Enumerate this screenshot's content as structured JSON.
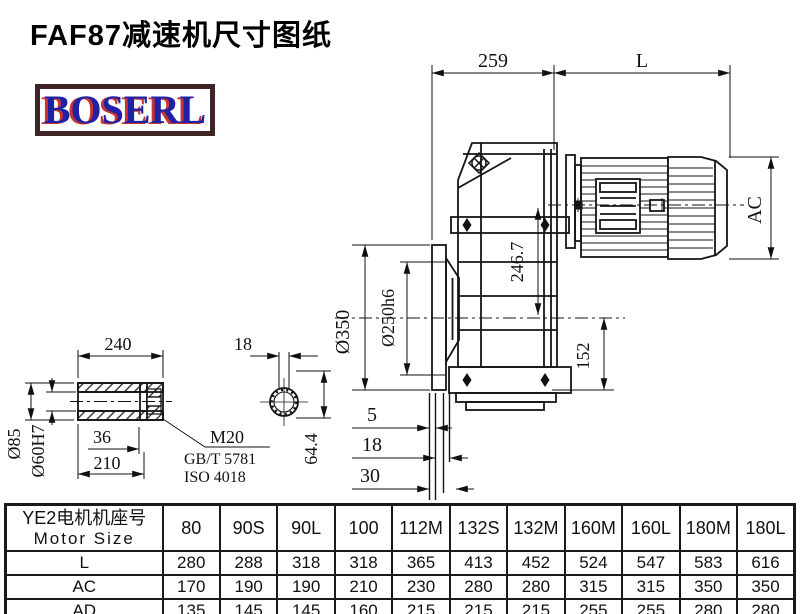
{
  "page": {
    "title": "FAF87减速机尺寸图纸",
    "logo": "BOSERL"
  },
  "colors": {
    "line": "#151515",
    "dim_line": "#111111",
    "logo_border": "#3e2424",
    "logo_text": "#2121a6",
    "logo_shadow": "#c63434"
  },
  "drawing": {
    "dims": {
      "d259": "259",
      "L": "L",
      "AC": "AC",
      "axis_distance": "246.7",
      "flange_od": "Ø350",
      "spigot": "Ø250h6",
      "d152": "152",
      "d5": "5",
      "d18": "18",
      "d30": "30"
    },
    "shaft": {
      "length": "240",
      "od": "Ø85",
      "bore": "Ø60H7",
      "d36": "36",
      "d210": "210",
      "thread": "M20",
      "std1": "GB/T 5781",
      "std2": "ISO 4018",
      "key_width": "18",
      "key_height": "64.4"
    }
  },
  "table": {
    "header": {
      "label_cn": "YE2电机机座号",
      "label_en": "Motor Size",
      "columns": [
        "80",
        "90S",
        "90L",
        "100",
        "112M",
        "132S",
        "132M",
        "160M",
        "160L",
        "180M",
        "180L"
      ]
    },
    "rows": [
      {
        "label": "L",
        "values": [
          "280",
          "288",
          "318",
          "318",
          "365",
          "413",
          "452",
          "524",
          "547",
          "583",
          "616"
        ]
      },
      {
        "label": "AC",
        "values": [
          "170",
          "190",
          "190",
          "210",
          "230",
          "280",
          "280",
          "315",
          "315",
          "350",
          "350"
        ]
      },
      {
        "label": "AD",
        "values": [
          "135",
          "145",
          "145",
          "160",
          "215",
          "215",
          "215",
          "255",
          "255",
          "280",
          "280"
        ]
      }
    ]
  }
}
